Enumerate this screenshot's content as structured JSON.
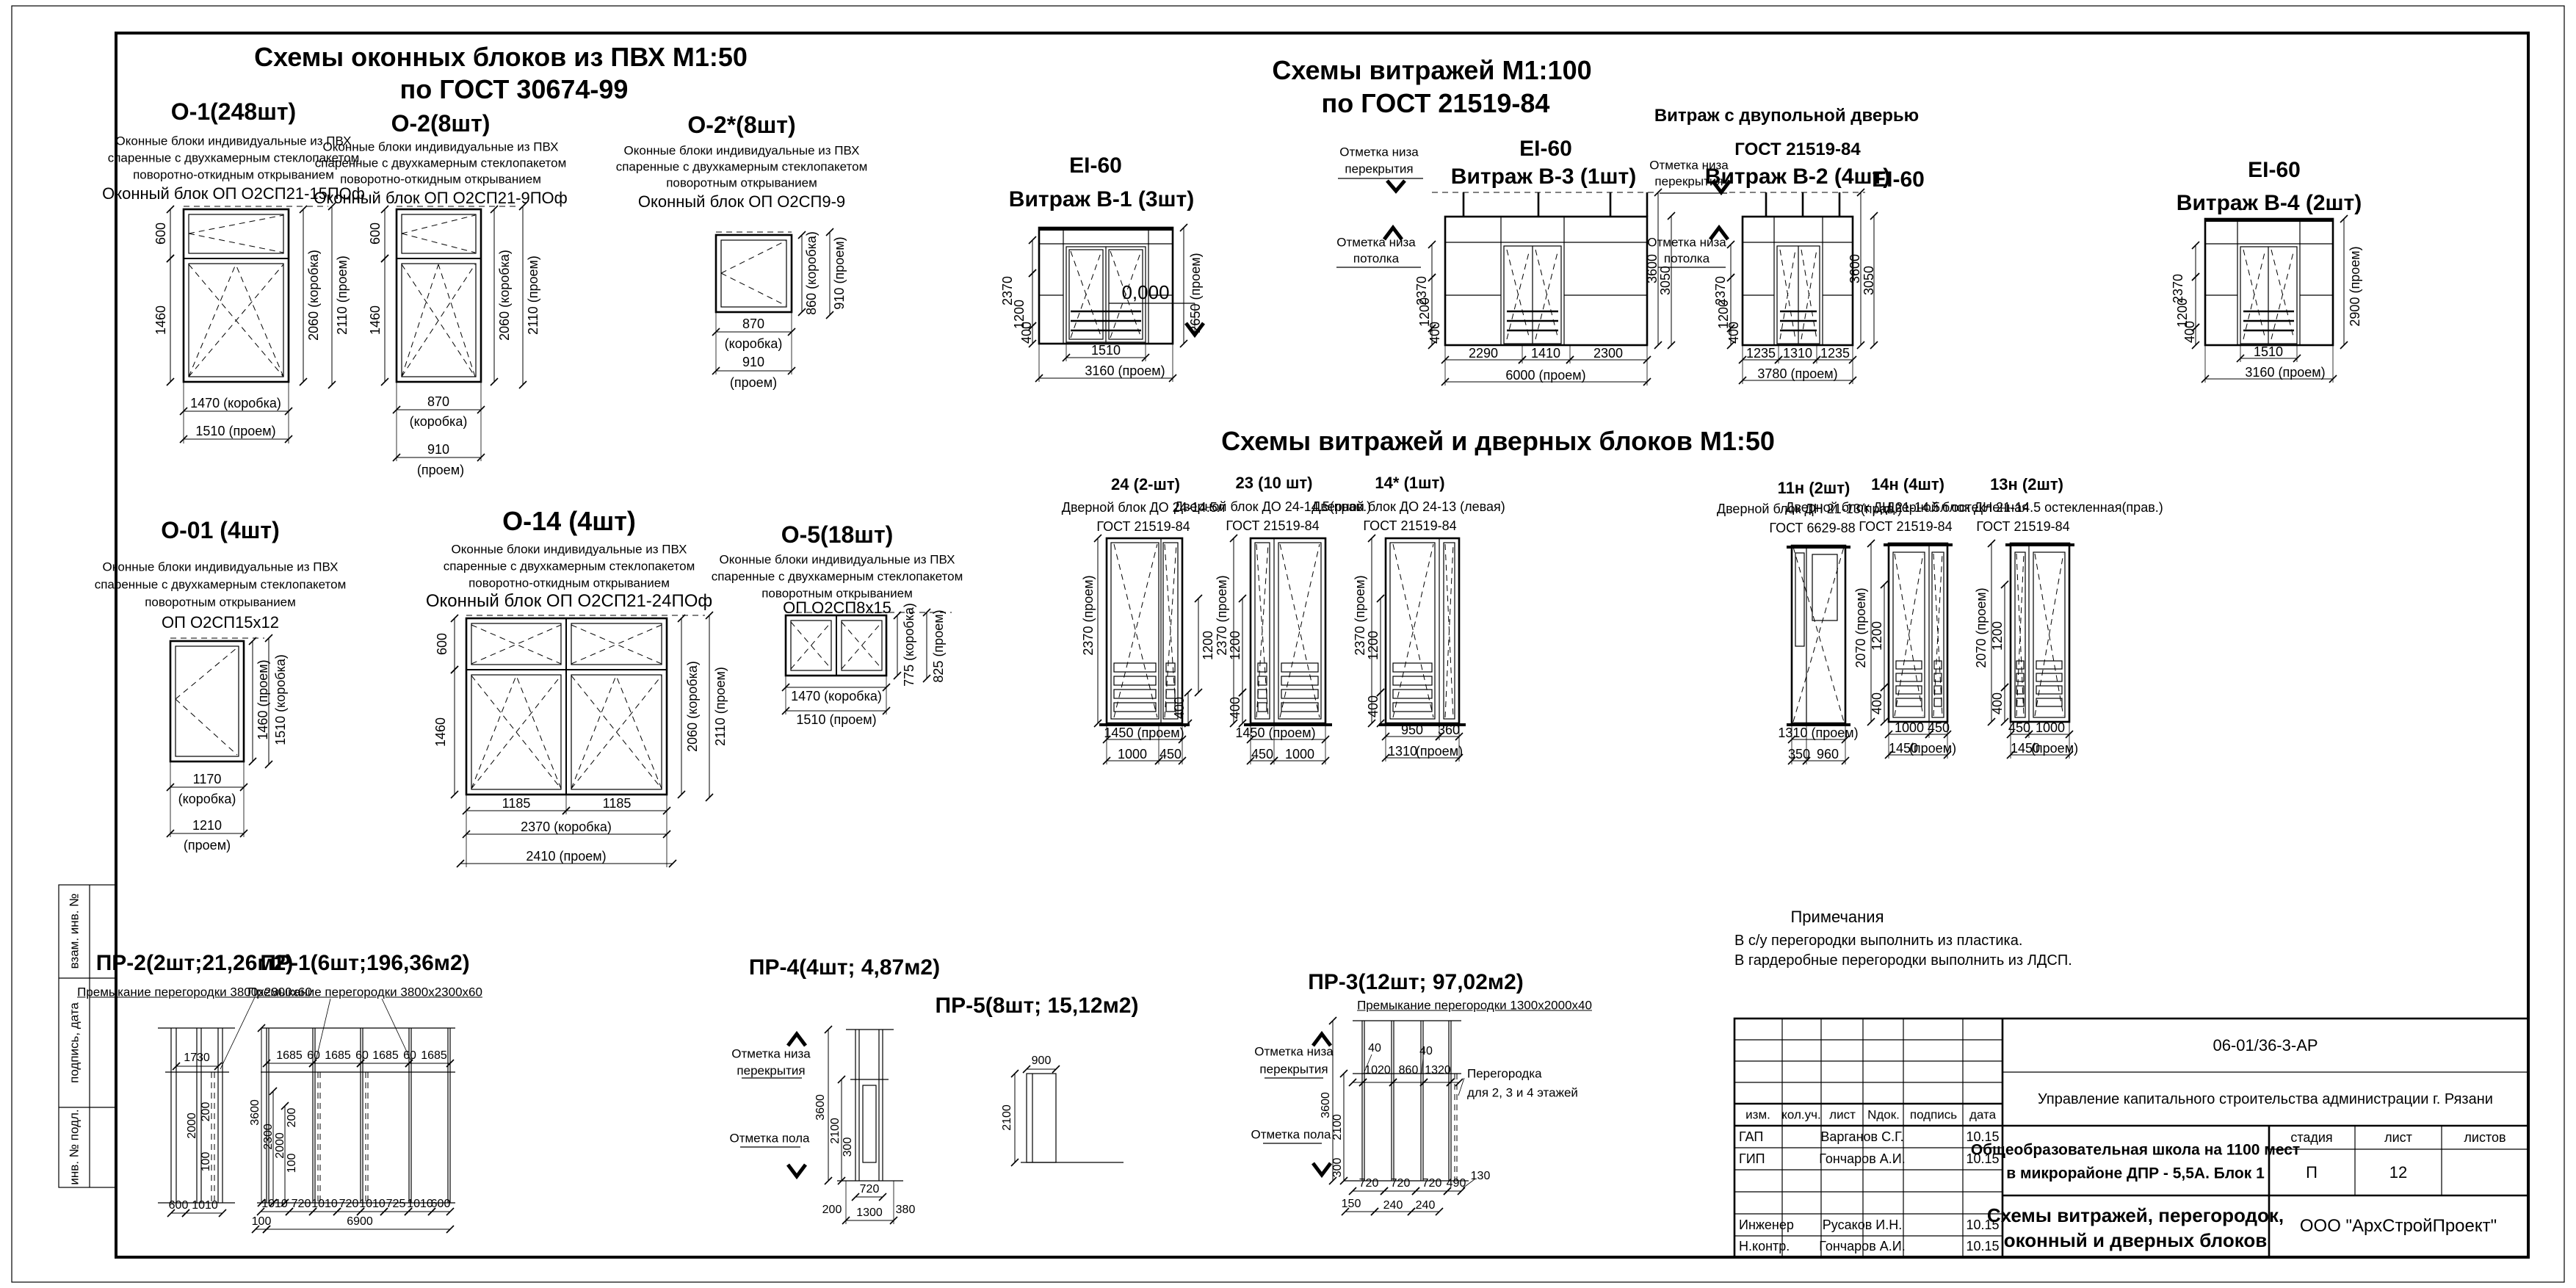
{
  "frame": {
    "side_labels": [
      "взам. инв. №",
      "подпись, дата",
      "инв. № подл."
    ]
  },
  "titles": {
    "win1": "Схемы оконных  блоков из ПВХ М1:50",
    "win2": "по ГОСТ 30674-99",
    "vit1": "Схемы витражей М1:100",
    "vit2": "по ГОСТ 21519-84",
    "vitdoor": "Схемы витражей и дверных блоков М1:50"
  },
  "wdesc": {
    "d1": "Оконные блоки индивидуальные из ПВХ",
    "d2": "спаренные с двухкамерным стеклопакетом",
    "d3a": "поворотно-откидным открыванием",
    "d3b": "поворотным открыванием"
  },
  "o1": {
    "title": "О-1(248шт)",
    "block": "Оконный блок ОП О2СП21-15ПОф",
    "h1": "600",
    "h2": "1460",
    "w1": "1470 (коробка)",
    "w2": "1510 (проем)",
    "v1": "2060 (коробка)",
    "v2": "2110 (проем)"
  },
  "o2": {
    "title": "О-2(8шт)",
    "block": "Оконный блок ОП О2СП21-9ПОф",
    "h1": "600",
    "h2": "1460",
    "w1a": "870",
    "w1b": "(коробка)",
    "w2a": "910",
    "w2b": "(проем)",
    "v1": "2060 (коробка)",
    "v2": "2110 (проем)"
  },
  "o2s": {
    "title": "О-2*(8шт)",
    "block": "Оконный блок ОП О2СП9-9",
    "v1": "860 (коробка)",
    "v2": "910 (проем)",
    "w1a": "870",
    "w1b": "(коробка)",
    "w2a": "910",
    "w2b": "(проем)"
  },
  "o01": {
    "title": "О-01 (4шт)",
    "block": "ОП О2СП15х12",
    "v1": "1460 (проем)",
    "v2": "1510 (коробка)",
    "w1a": "1170",
    "w1b": "(коробка)",
    "w2a": "1210",
    "w2b": "(проем)"
  },
  "o14": {
    "title": "О-14 (4шт)",
    "block": "Оконный блок ОП О2СП21-24ПОф",
    "h1": "600",
    "h2": "1460",
    "b1": "1185",
    "b2": "1185",
    "w1": "2370 (коробка)",
    "w2": "2410 (проем)",
    "v1": "2060 (коробка)",
    "v2": "2110 (проем)"
  },
  "o5": {
    "title": "О-5(18шт)",
    "block": "ОП О2СП8х15",
    "v1": "775 (коробка)",
    "v2": "825 (проем)",
    "w1": "1470 (коробка)",
    "w2": "1510 (проем)"
  },
  "b1": {
    "fire": "EI-60",
    "title": "Витраж В-1 (3шт)",
    "l1": "2370",
    "l2": "1200",
    "l3": "400",
    "r1": "2650 (проем)",
    "b1": "1510",
    "b2": "3160 (проем)"
  },
  "b3": {
    "fire": "EI-60",
    "title": "Витраж В-3 (1шт)",
    "m1a": "Отметка низа",
    "m1b": "перекрытия",
    "m2a": "Отметка низа",
    "m2b": "потолка",
    "zero": "0,000",
    "l1": "2370",
    "l2": "1200",
    "l3": "400",
    "r1": "3600",
    "r2": "3050",
    "b1": "2290",
    "b2": "1410",
    "b3": "2300",
    "b4": "6000  (проем)"
  },
  "b2": {
    "top1": "Витраж с двупольной дверью",
    "top2": "ГОСТ 21519-84",
    "title": "Витраж В-2 (4шт)",
    "fire": "EI-60",
    "m1a": "Отметка низа",
    "m1b": "перекрытия",
    "m2a": "Отметка низа",
    "m2b": "потолка",
    "l1": "2370",
    "l2": "1200",
    "l3": "400",
    "r1": "3600",
    "r2": "3050",
    "b1": "1235",
    "b2": "1310",
    "b3": "1235",
    "b4": "3780 (проем)"
  },
  "b4": {
    "fire": "EI-60",
    "title": "Витраж В-4 (2шт)",
    "l1": "2370",
    "l2": "1200",
    "l3": "400",
    "r1": "2900 (проем)",
    "b1": "1510",
    "b2": "3160 (проем)"
  },
  "d24": {
    "title": "24 (2-шт)",
    "s1": "Дверной блок ДО 24-14.5л",
    "s2": "ГОСТ 21519-84",
    "l1": "2370 (проем)",
    "r1": "1200",
    "r2": "400",
    "b1": "1450 (проем)",
    "b2": "1000",
    "b3": "450"
  },
  "d23": {
    "title": "23 (10 шт)",
    "s1": "Дверной блок ДО 24-14.5(прав.)",
    "s2": "ГОСТ 21519-84",
    "l1": "2370  (проем)",
    "l2": "1200",
    "l3": "400",
    "b1": "1450  (проем)",
    "b2": "450",
    "b3": "1000"
  },
  "d14s": {
    "title": "14* (1шт)",
    "s1": "Дверной блок ДО 24-13 (левая)",
    "s2": "ГОСТ 21519-84",
    "l1": "2370  (проем)",
    "l2": "1200",
    "l3": "400",
    "b1": "950",
    "b2": "360",
    "b3": "1310",
    "b4": "(проем)"
  },
  "d11n": {
    "title": "11н (2шт)",
    "s1": "Дверной блок ДН 21-13(прав.)",
    "s2": "ГОСТ 6629-88",
    "b1": "1310 (проем)",
    "b2": "350",
    "b3": "960"
  },
  "d14n": {
    "title": "14н (4шт)",
    "s1": "Дверной блок ДН 21-14.5л остекленная",
    "s2": "ГОСТ 21519-84",
    "l1": "2070  (проем)",
    "l2": "1200",
    "l3": "400",
    "b1": "1000",
    "b2": "450",
    "b3": "1450",
    "b4": "(проем)"
  },
  "d13n": {
    "title": "13н (2шт)",
    "s1": "Дверной блок ДН 21-14.5 остекленная(прав.)",
    "s2": "ГОСТ 21519-84",
    "l1": "2070  (проем)",
    "l2": "1200",
    "l3": "400",
    "b1": "450",
    "b2": "1000",
    "b3": "1450",
    "b4": "(проем)"
  },
  "pr2": {
    "title": "ПР-2(2шт;21,26м2)",
    "sub": "Премыкание перегородки 3800х2300х60",
    "t1": "1730",
    "i1": "2000",
    "i2": "200",
    "i3": "100",
    "b1": "600",
    "b2": "1010"
  },
  "pr1": {
    "title": "ПР-1(6шт;196,36м2)",
    "sub": "Премыкание перегородки 3800х2300х60",
    "t": [
      "1685",
      "60",
      "1685",
      "60",
      "1685",
      "60",
      "1685"
    ],
    "l1": "3600",
    "l2": "2300",
    "i1": "2000",
    "i2": "200",
    "i3": "100",
    "b": [
      "1010",
      "720",
      "1010",
      "720",
      "1010",
      "725",
      "1010",
      "600"
    ],
    "c1": "100",
    "c2": "6900"
  },
  "pr4": {
    "title": "ПР-4(4шт; 4,87м2)",
    "m1a": "Отметка низа",
    "m1b": "перекрытия",
    "m2": "Отметка пола",
    "l1": "3600",
    "l2": "2100",
    "l3": "300",
    "b1": "720",
    "b2": "200",
    "b3": "1300",
    "b4": "380"
  },
  "pr5": {
    "title": "ПР-5(8шт; 15,12м2)",
    "w": "900",
    "h": "2100"
  },
  "pr3": {
    "title": "ПР-3(12шт; 97,02м2)",
    "sub": "Премыкание перегородки 1300х2000х40",
    "m1a": "Отметка низа",
    "m1b": "перекрытия",
    "m2": "Отметка пола",
    "n1": "Перегородка",
    "n2": "для 2, 3 и 4 этажей",
    "t1": "40",
    "t2": "40",
    "w1": "1020",
    "w2": "860",
    "w3": "1320",
    "l1": "3600",
    "l2": "2100",
    "l3": "300",
    "b1": "720",
    "b2": "720",
    "b3": "720",
    "b4": "490",
    "b5": "130",
    "c1": "150",
    "c2": "240",
    "c3": "240"
  },
  "notes": {
    "title": "Примечания",
    "n1": "В с/у перегородки выполнить из пластика.",
    "n2": "В гардеробные перегородки выполнить из ЛДСП."
  },
  "stamp": {
    "doc": "06-01/36-3-АР",
    "org": "Управление капитального строительства администрации г. Рязани",
    "cols": [
      "изм.",
      "кол.уч.",
      "лист",
      "Nдок.",
      "подпись",
      "дата"
    ],
    "rows": [
      {
        "role": "ГАП",
        "name": "Варганов С.Г.",
        "date": "10.15"
      },
      {
        "role": "ГИП",
        "name": "Гончаров А.И.",
        "date": "10.15"
      },
      {
        "role": "",
        "name": "",
        "date": ""
      },
      {
        "role": "",
        "name": "",
        "date": ""
      },
      {
        "role": "Инженер",
        "name": "Русаков И.Н.",
        "date": "10.15"
      },
      {
        "role": "Н.контр.",
        "name": "Гончаров А.И.",
        "date": "10.15"
      }
    ],
    "object1": "Общеобразовательная школа на 1100 мест",
    "object2": "в микрорайоне ДПР - 5,5А. Блок 1",
    "stage_h": "стадия",
    "sheet_h": "лист",
    "sheets_h": "листов",
    "stage": "П",
    "sheet_no": "12",
    "subject1": "Схемы витражей, перегородок,",
    "subject2": "оконный и дверных блоков",
    "company": "ООО \"АрхСтройПроект\""
  }
}
